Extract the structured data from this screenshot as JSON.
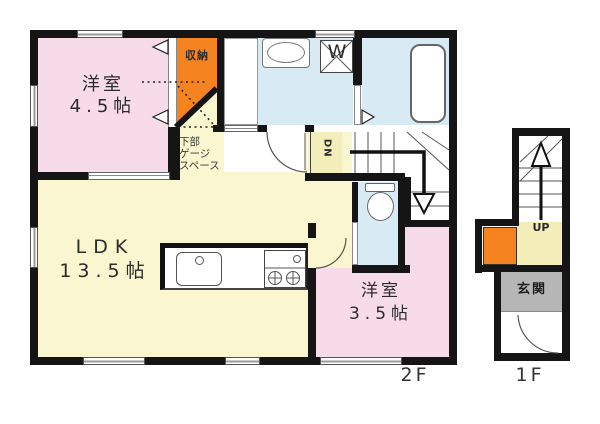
{
  "plan": {
    "floor2": {
      "floor_label": "2F",
      "room_45": {
        "name": "洋室",
        "size": "4.5帖"
      },
      "ldk": {
        "name": "LDK",
        "size": "13.5帖"
      },
      "room_35": {
        "name": "洋室",
        "size": "3.5帖"
      },
      "storage_label": "収納",
      "under_space": [
        "下部",
        "ゲージ",
        "スペース"
      ],
      "stairs_down_label": "DN",
      "washer_label": "W"
    },
    "floor1": {
      "floor_label": "1F",
      "entrance_label": "玄関",
      "stairs_up_label": "UP"
    },
    "colors": {
      "wall": "#151515",
      "room_pink": "#f8dbe8",
      "ldk_yellow": "#faf6cf",
      "stair_cream": "#f3edba",
      "wet_blue": "#d8ebf5",
      "storage_orange": "#f5831f",
      "entrance_gray": "#b6b6b6"
    }
  }
}
